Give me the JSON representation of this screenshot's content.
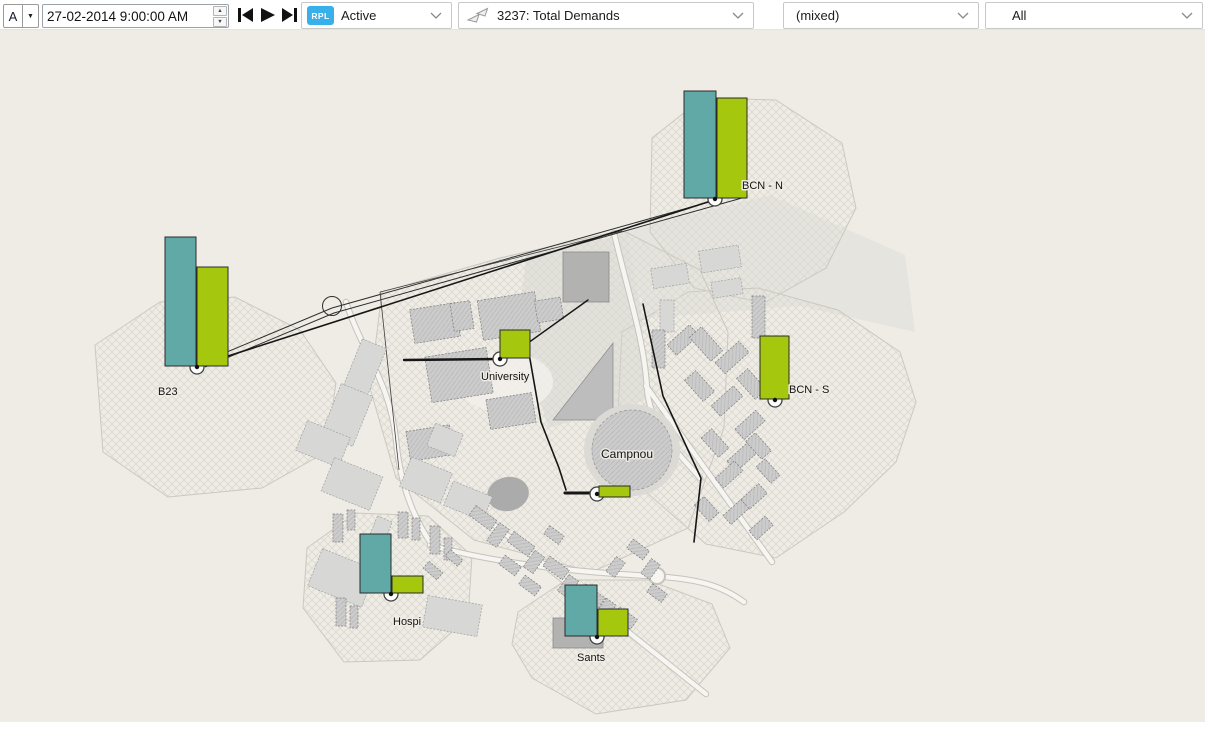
{
  "toolbar": {
    "frame_button_label": "A",
    "datetime_value": "27-02-2014 9:00:00 AM",
    "rpl": {
      "badge": "RPL",
      "value": "Active"
    },
    "demands": {
      "value": "3237: Total Demands"
    },
    "mixed": {
      "value": "(mixed)"
    },
    "scope": {
      "value": "All"
    }
  },
  "icons": {
    "caret_down": "▼",
    "spinner_up": "▲",
    "spinner_down": "▼"
  },
  "map": {
    "background": "#efece5",
    "colors": {
      "teal": "#61a9a7",
      "green": "#a5c70e"
    },
    "sites": [
      {
        "name": "B23",
        "label": {
          "x": 158,
          "y": 395
        },
        "node": {
          "x": 197,
          "y": 367
        },
        "bars": [
          {
            "color": "teal",
            "x": 165,
            "y": 237,
            "w": 31,
            "h": 129
          },
          {
            "color": "green",
            "x": 197,
            "y": 267,
            "w": 31,
            "h": 99
          }
        ]
      },
      {
        "name": "BCN - N",
        "label": {
          "x": 742,
          "y": 189
        },
        "node": {
          "x": 715,
          "y": 199
        },
        "bars": [
          {
            "color": "teal",
            "x": 684,
            "y": 91,
            "w": 32,
            "h": 107
          },
          {
            "color": "green",
            "x": 717,
            "y": 98,
            "w": 30,
            "h": 100
          }
        ]
      },
      {
        "name": "BCN - S",
        "label": {
          "x": 789,
          "y": 393
        },
        "node": {
          "x": 775,
          "y": 400
        },
        "bars": [
          {
            "color": "green",
            "x": 760,
            "y": 336,
            "w": 29,
            "h": 63
          }
        ]
      },
      {
        "name": "University",
        "label": {
          "x": 481,
          "y": 380
        },
        "node": {
          "x": 500,
          "y": 359
        },
        "bars": [
          {
            "color": "green",
            "x": 500,
            "y": 330,
            "w": 30,
            "h": 28
          }
        ]
      },
      {
        "name": "",
        "node": {
          "x": 597,
          "y": 494
        },
        "bars": [
          {
            "color": "green",
            "x": 599,
            "y": 486,
            "w": 31,
            "h": 11
          }
        ]
      },
      {
        "name": "Hospi",
        "label": {
          "x": 393,
          "y": 625
        },
        "node": {
          "x": 391,
          "y": 594
        },
        "bars": [
          {
            "color": "teal",
            "x": 360,
            "y": 534,
            "w": 31,
            "h": 59
          },
          {
            "color": "green",
            "x": 392,
            "y": 576,
            "w": 31,
            "h": 17
          }
        ]
      },
      {
        "name": "Sants",
        "label": {
          "x": 577,
          "y": 661
        },
        "node": {
          "x": 597,
          "y": 637
        },
        "bars": [
          {
            "color": "teal",
            "x": 565,
            "y": 585,
            "w": 32,
            "h": 51
          },
          {
            "color": "green",
            "x": 598,
            "y": 609,
            "w": 30,
            "h": 27
          }
        ]
      }
    ],
    "labels": [
      {
        "text": "Campnou",
        "x": 601,
        "y": 458
      }
    ]
  }
}
